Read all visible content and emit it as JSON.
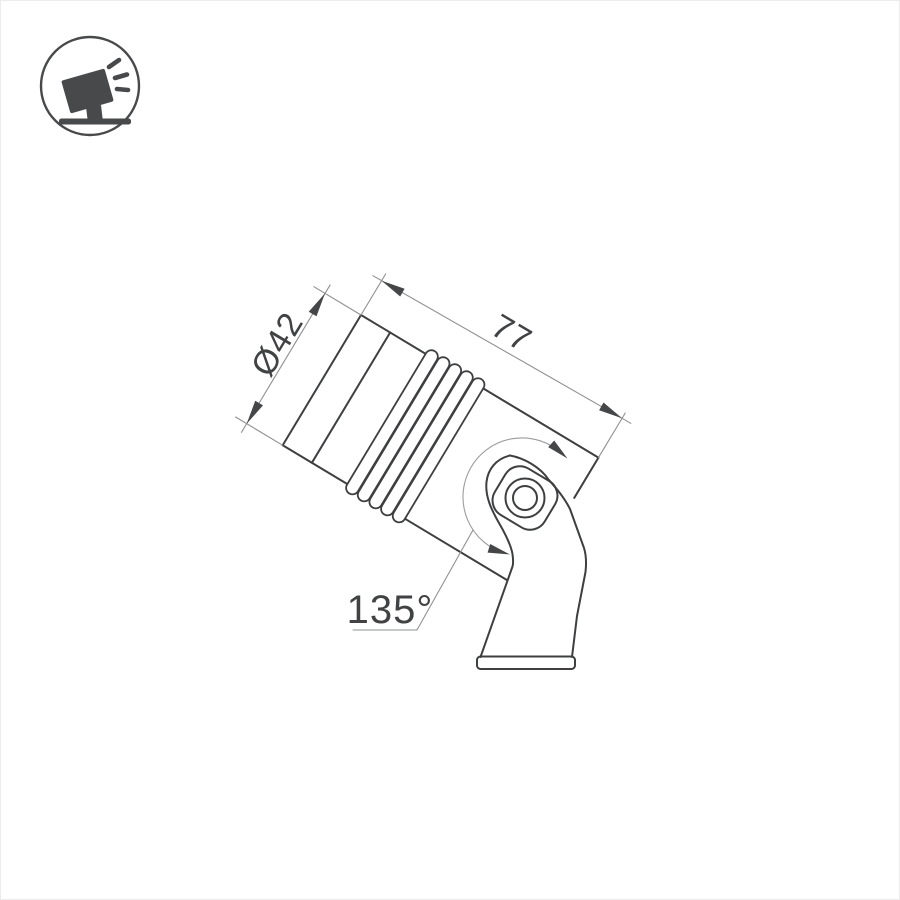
{
  "drawing": {
    "type": "luminaire-technical-dimension-drawing",
    "dimensions": {
      "diameter_label": "Ø42",
      "length_label": "77",
      "rotation_angle_label": "135°"
    }
  },
  "logo": {
    "icon": "tilted-spotlight-on-stand"
  },
  "colors": {
    "background": "#ffffff",
    "border": "#ececec",
    "outline": "#3e3f41",
    "thinline": "#8f9092",
    "arcline": "#9b9c9e",
    "arrow": "#454648",
    "text": "#414244",
    "logo": "#48494b"
  }
}
